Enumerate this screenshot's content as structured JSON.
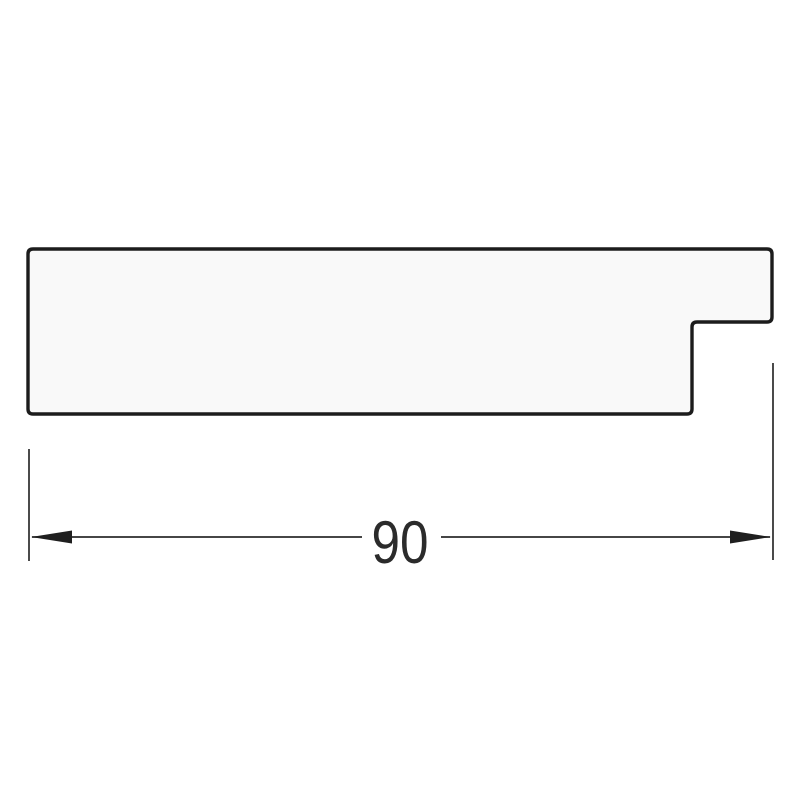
{
  "page": {
    "background_color": "#ffffff"
  },
  "drawing": {
    "kind": "profile-cross-section",
    "profile": {
      "fill_color": "#f9f9f9",
      "outline_color": "#1c1c1c",
      "outline_width_px": 3.4
    },
    "dimension": {
      "value_label": "90",
      "line_color": "#2b2b2b",
      "text_color": "#2b2b2b",
      "arrow_color": "#1f1f1f"
    }
  }
}
